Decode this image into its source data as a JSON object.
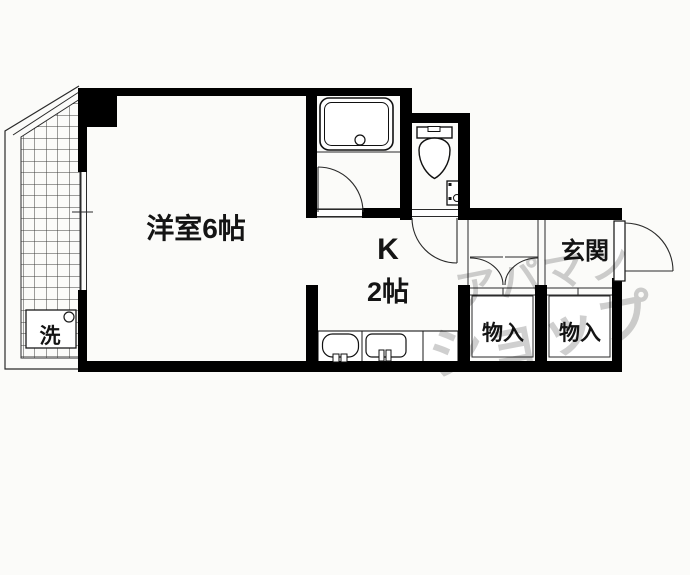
{
  "floorplan": {
    "rooms": {
      "main_room_label": "洋室6帖",
      "kitchen_letter": "K",
      "kitchen_size": "2帖",
      "entrance_label": "玄関",
      "storage_left_label": "物入",
      "storage_right_label": "物入",
      "washer_label": "洗"
    },
    "watermark": {
      "line1": "アパマン",
      "line2": "ショップ"
    },
    "colors": {
      "wall": "#000000",
      "thin_line": "#2a2a2a",
      "hatch_line": "#3c3c3c",
      "watermark": "#c7c7c7",
      "background": "#fbfbf9"
    },
    "icons": [
      "balcony-hatch",
      "washing-machine-pan-icon",
      "bathtub-icon",
      "toilet-icon",
      "corner-sink-icon",
      "stove-icon",
      "kitchen-sink-icon",
      "entrance-door-swing-icon",
      "bath-door-swing-icon",
      "toilet-door-swing-icon",
      "closet-double-door-icon",
      "window-lines"
    ]
  }
}
